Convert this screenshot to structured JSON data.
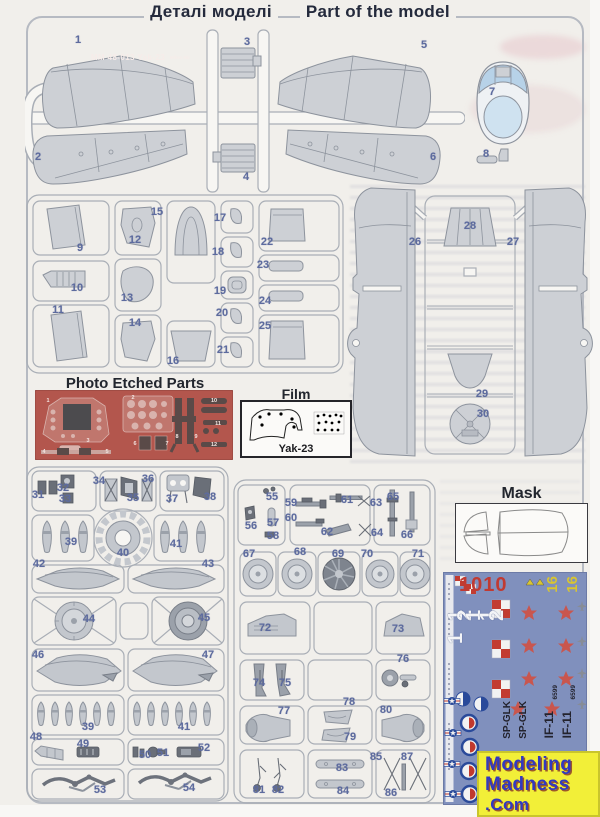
{
  "title": {
    "cyrillic": "Деталі моделі",
    "english": "Part of the model"
  },
  "sections": {
    "photo_etched": {
      "heading": "Photo Etched Parts",
      "code": "MM 48-013 Yak-23",
      "brand": "Mikro Mir"
    },
    "film": {
      "heading": "Film",
      "label": "Yak-23"
    },
    "mask": {
      "heading": "Mask"
    },
    "watermark": {
      "line1": "Modeling",
      "line2": "Madness",
      "line3": ".Com"
    }
  },
  "decal_sheet": {
    "numbers_red": "1010",
    "numbers_white": "121 121",
    "numbers_yellow": [
      "16",
      "16"
    ],
    "codes_black": [
      "SP-GLK",
      "SP-GLK",
      "IF-11",
      "IF-11"
    ],
    "serials": [
      "6599",
      "6599"
    ]
  },
  "colors": {
    "paper": "#f1efeb",
    "part_gray": "#cdd0d5",
    "number_blue": "#5d6b9e",
    "pe_red": "#b3564d",
    "decal_blue": "#8090bd",
    "watermark_yellow": "#f2ef38",
    "watermark_blue": "#3239c0"
  },
  "part_labels": [
    {
      "n": "1",
      "x": 78,
      "y": 40
    },
    {
      "n": "2",
      "x": 38,
      "y": 157
    },
    {
      "n": "3",
      "x": 247,
      "y": 42
    },
    {
      "n": "4",
      "x": 246,
      "y": 177
    },
    {
      "n": "5",
      "x": 424,
      "y": 45
    },
    {
      "n": "6",
      "x": 433,
      "y": 157
    },
    {
      "n": "7",
      "x": 492,
      "y": 92
    },
    {
      "n": "8",
      "x": 486,
      "y": 154
    },
    {
      "n": "9",
      "x": 80,
      "y": 248
    },
    {
      "n": "10",
      "x": 77,
      "y": 288
    },
    {
      "n": "11",
      "x": 58,
      "y": 310
    },
    {
      "n": "12",
      "x": 135,
      "y": 240
    },
    {
      "n": "13",
      "x": 127,
      "y": 298
    },
    {
      "n": "14",
      "x": 135,
      "y": 323
    },
    {
      "n": "15",
      "x": 157,
      "y": 212
    },
    {
      "n": "16",
      "x": 173,
      "y": 361
    },
    {
      "n": "17",
      "x": 220,
      "y": 218
    },
    {
      "n": "18",
      "x": 218,
      "y": 252
    },
    {
      "n": "19",
      "x": 220,
      "y": 291
    },
    {
      "n": "20",
      "x": 222,
      "y": 313
    },
    {
      "n": "21",
      "x": 223,
      "y": 350
    },
    {
      "n": "22",
      "x": 267,
      "y": 242
    },
    {
      "n": "23",
      "x": 263,
      "y": 265
    },
    {
      "n": "24",
      "x": 265,
      "y": 301
    },
    {
      "n": "25",
      "x": 265,
      "y": 326
    },
    {
      "n": "26",
      "x": 415,
      "y": 242
    },
    {
      "n": "27",
      "x": 513,
      "y": 242
    },
    {
      "n": "28",
      "x": 470,
      "y": 226
    },
    {
      "n": "29",
      "x": 482,
      "y": 394
    },
    {
      "n": "30",
      "x": 483,
      "y": 414
    },
    {
      "n": "31",
      "x": 38,
      "y": 495
    },
    {
      "n": "32",
      "x": 63,
      "y": 488
    },
    {
      "n": "33",
      "x": 65,
      "y": 499
    },
    {
      "n": "34",
      "x": 99,
      "y": 481
    },
    {
      "n": "35",
      "x": 133,
      "y": 498
    },
    {
      "n": "36",
      "x": 148,
      "y": 479
    },
    {
      "n": "37",
      "x": 172,
      "y": 499
    },
    {
      "n": "38",
      "x": 210,
      "y": 497
    },
    {
      "n": "39",
      "x": 71,
      "y": 542
    },
    {
      "n": "40",
      "x": 123,
      "y": 553
    },
    {
      "n": "41",
      "x": 176,
      "y": 544
    },
    {
      "n": "42",
      "x": 39,
      "y": 564
    },
    {
      "n": "43",
      "x": 208,
      "y": 564
    },
    {
      "n": "44",
      "x": 89,
      "y": 619
    },
    {
      "n": "45",
      "x": 204,
      "y": 618
    },
    {
      "n": "46",
      "x": 38,
      "y": 655
    },
    {
      "n": "47",
      "x": 208,
      "y": 655
    },
    {
      "n": "39",
      "x": 88,
      "y": 727
    },
    {
      "n": "41",
      "x": 184,
      "y": 727
    },
    {
      "n": "48",
      "x": 36,
      "y": 737
    },
    {
      "n": "49",
      "x": 83,
      "y": 744
    },
    {
      "n": "50",
      "x": 145,
      "y": 755
    },
    {
      "n": "51",
      "x": 163,
      "y": 753
    },
    {
      "n": "52",
      "x": 204,
      "y": 748
    },
    {
      "n": "53",
      "x": 100,
      "y": 790
    },
    {
      "n": "54",
      "x": 189,
      "y": 788
    },
    {
      "n": "55",
      "x": 272,
      "y": 497
    },
    {
      "n": "56",
      "x": 251,
      "y": 526
    },
    {
      "n": "57",
      "x": 273,
      "y": 523
    },
    {
      "n": "58",
      "x": 273,
      "y": 536
    },
    {
      "n": "59",
      "x": 291,
      "y": 503
    },
    {
      "n": "60",
      "x": 291,
      "y": 518
    },
    {
      "n": "61",
      "x": 347,
      "y": 500
    },
    {
      "n": "62",
      "x": 327,
      "y": 532
    },
    {
      "n": "63",
      "x": 376,
      "y": 503
    },
    {
      "n": "64",
      "x": 377,
      "y": 533
    },
    {
      "n": "65",
      "x": 393,
      "y": 497
    },
    {
      "n": "66",
      "x": 407,
      "y": 535
    },
    {
      "n": "67",
      "x": 249,
      "y": 554
    },
    {
      "n": "68",
      "x": 300,
      "y": 552
    },
    {
      "n": "69",
      "x": 338,
      "y": 554
    },
    {
      "n": "70",
      "x": 367,
      "y": 554
    },
    {
      "n": "71",
      "x": 418,
      "y": 554
    },
    {
      "n": "72",
      "x": 265,
      "y": 628
    },
    {
      "n": "73",
      "x": 398,
      "y": 629
    },
    {
      "n": "74",
      "x": 259,
      "y": 683
    },
    {
      "n": "75",
      "x": 285,
      "y": 683
    },
    {
      "n": "76",
      "x": 403,
      "y": 659
    },
    {
      "n": "77",
      "x": 284,
      "y": 711
    },
    {
      "n": "78",
      "x": 349,
      "y": 702
    },
    {
      "n": "79",
      "x": 350,
      "y": 737
    },
    {
      "n": "80",
      "x": 386,
      "y": 710
    },
    {
      "n": "81",
      "x": 259,
      "y": 790
    },
    {
      "n": "82",
      "x": 278,
      "y": 790
    },
    {
      "n": "83",
      "x": 342,
      "y": 768
    },
    {
      "n": "84",
      "x": 343,
      "y": 791
    },
    {
      "n": "85",
      "x": 376,
      "y": 757
    },
    {
      "n": "86",
      "x": 391,
      "y": 793
    },
    {
      "n": "87",
      "x": 407,
      "y": 757
    }
  ],
  "pe_labels": [
    {
      "n": "1",
      "x": 48,
      "y": 401
    },
    {
      "n": "2",
      "x": 133,
      "y": 398
    },
    {
      "n": "3",
      "x": 88,
      "y": 441
    },
    {
      "n": "4",
      "x": 44,
      "y": 452
    },
    {
      "n": "5",
      "x": 107,
      "y": 452
    },
    {
      "n": "6",
      "x": 135,
      "y": 444
    },
    {
      "n": "7",
      "x": 167,
      "y": 444
    },
    {
      "n": "8",
      "x": 177,
      "y": 437
    },
    {
      "n": "9",
      "x": 196,
      "y": 437
    },
    {
      "n": "10",
      "x": 214,
      "y": 401
    },
    {
      "n": "11",
      "x": 218,
      "y": 424
    },
    {
      "n": "12",
      "x": 214,
      "y": 445
    }
  ]
}
